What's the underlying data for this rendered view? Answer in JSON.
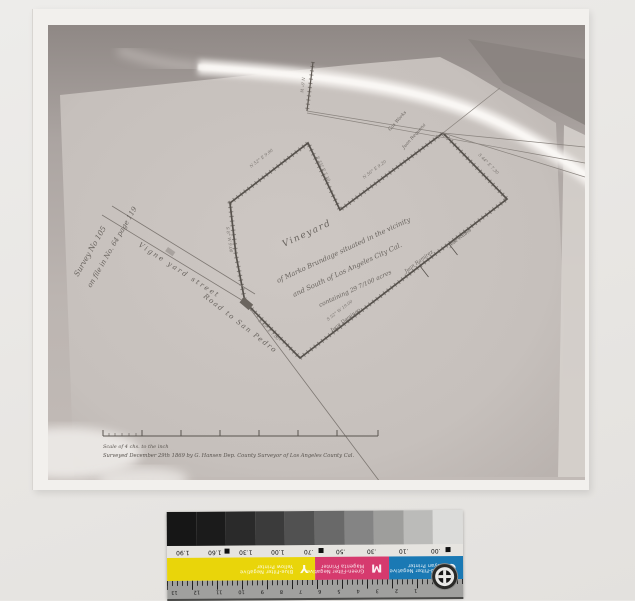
{
  "map": {
    "title": {
      "l1": "Vineyard",
      "l2": "of Marko Brundage situated in the vicinity",
      "l3": "and South of Los Angeles City Cal.",
      "l4": "containing 29 7/100 acres"
    },
    "margin_note": {
      "l1": "Survey No 105",
      "l2": "on file in No. 64  page 119"
    },
    "streets": {
      "s1": "Vigne yard street",
      "s2": "Road to San Pedro"
    },
    "neighbors": {
      "n1": "Juan Ramirez",
      "n2": "José Rubio",
      "n3": "Juan Domingo",
      "n4": "Gas Works",
      "n5": "Juan Requena"
    },
    "bearings": {
      "b1": "N 52° E 9.90",
      "b2": "S 35° E 7.10",
      "b3": "N 56° E 9.20",
      "b4": "S 44° E 7.30",
      "b5": "S 52° W 19.00",
      "b6": "S 8° W 9.00",
      "b7": "S 45° E 7.00",
      "b8": "N 6° W"
    },
    "scale_caption": "Scale of 4 chs. to the inch",
    "survey_caption": "Surveyed December 29th 1869 by G. Hansen Dep. County Surveyor of Los Angeles County Cal."
  },
  "strip": {
    "density_labels": [
      "1.90",
      "1.60",
      "1.30",
      "1.00",
      ".70",
      ".50",
      ".30",
      ".10",
      ".00"
    ],
    "gray_steps": [
      "#161616",
      "#1b1b1b",
      "#2a2a2a",
      "#3b3b3b",
      "#515151",
      "#696969",
      "#848484",
      "#9e9e9c",
      "#bbbbb9",
      "#dcdcda"
    ],
    "patches": [
      {
        "letter": "Y",
        "line1": "Blue-Filter Negative",
        "line2": "Yellow Printer",
        "color": "#e9d50a"
      },
      {
        "letter": "M",
        "line1": "Green-Filter Negative",
        "line2": "Magenta Printer",
        "color": "#d63a6e"
      },
      {
        "letter": "C",
        "line1": "Red-Filter Negative",
        "line2": "Cyan Printer",
        "color": "#1a79b4"
      }
    ],
    "ruler_numbers": [
      "1",
      "2",
      "3",
      "4",
      "5",
      "6",
      "7",
      "8",
      "9",
      "10",
      "11",
      "12",
      "13"
    ]
  }
}
